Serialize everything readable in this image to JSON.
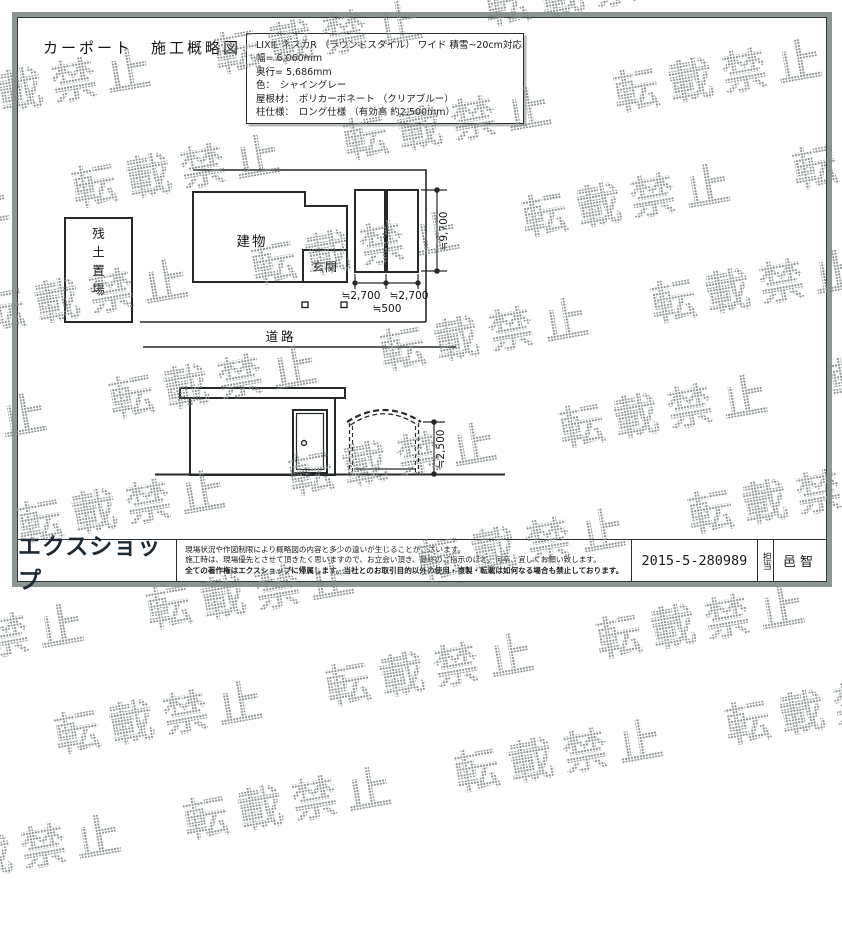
{
  "watermark": {
    "text": "転載禁止",
    "color": "#989e9d"
  },
  "title": "カーポート　施工概略図",
  "spec_box": {
    "lines": [
      "LIXIL ネスカR （ラウンドスタイル） ワイド 積雪~20cm対応",
      "幅= 6,060mm",
      "奥行= 5,686mm",
      "色：　シャイングレー",
      "屋根材：　ポリカーボネート （クリアブルー）",
      "柱仕様：　ロング仕様 （有効高 約2,500mm）"
    ]
  },
  "plan": {
    "labels": {
      "soil": "残土置場",
      "building": "建物",
      "entrance": "玄関",
      "road": "道路"
    },
    "dims": {
      "depth": "≒9,700",
      "width_left": "≒2,700",
      "width_right": "≒2,700",
      "setback": "≒500"
    }
  },
  "elevation": {
    "dims": {
      "height": "≒2,500"
    }
  },
  "footer": {
    "logo": "エクスショップ",
    "disclaimer": [
      "現場状況や作図制限により概略図の内容と多少の違いが生じることがございます。",
      "施工時は、現場優先とさせて頂きたく思いますので、お立会い頂き、最終のご指示のほど、何卒、宜しくお願い致します。",
      "全ての著作権はエクスショップに帰属します。当社とのお取引目的以外の使用・複製・転載は如何なる場合も禁止しております。"
    ],
    "doc_number": "2015-5-280989",
    "staff_label": "担当",
    "staff_name": "邑智"
  }
}
